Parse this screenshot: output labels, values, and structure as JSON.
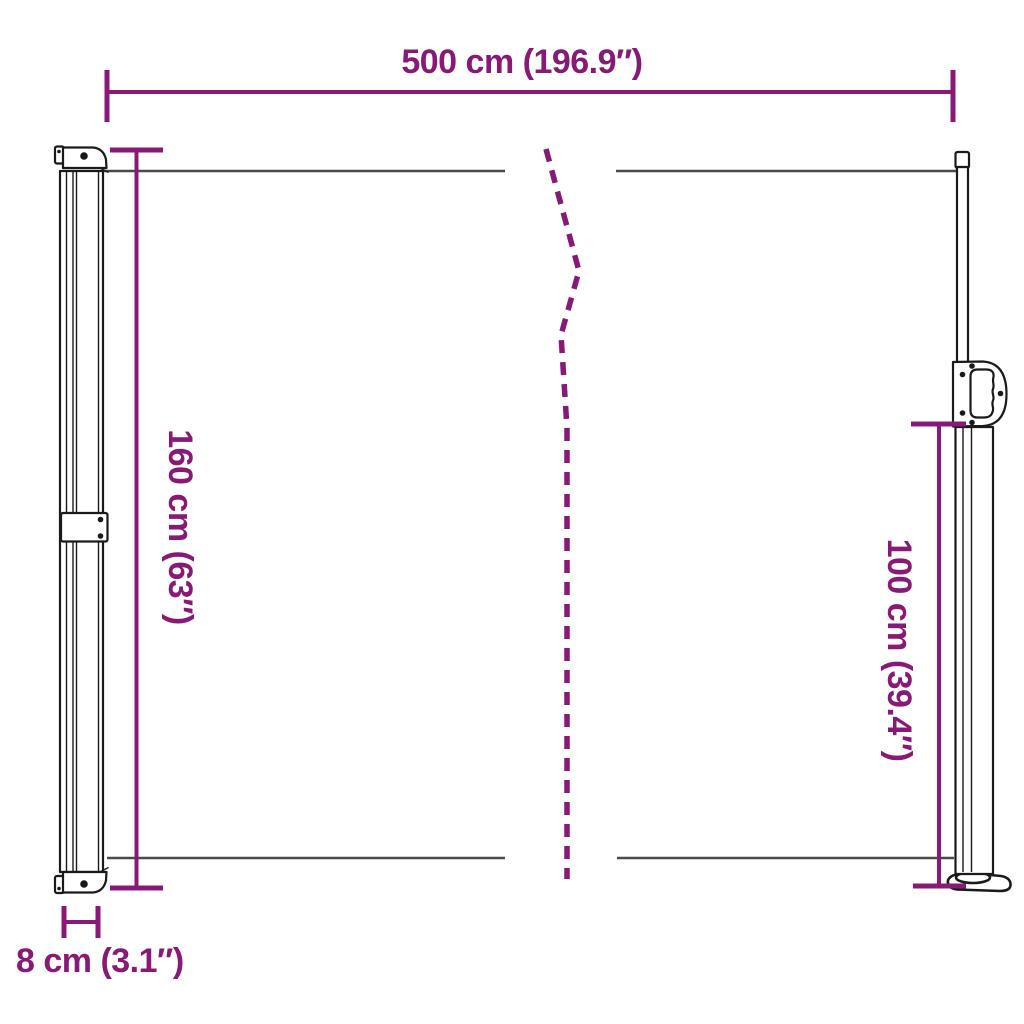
{
  "diagram": {
    "dimension_labels": {
      "width": "500 cm (196.9″)",
      "height_left": "160 cm (63″)",
      "height_right": "100 cm (39.4″)",
      "depth": "8 cm (3.1″)"
    },
    "dimension_values": {
      "width_cm": 500,
      "width_in": 196.9,
      "height_left_cm": 160,
      "height_left_in": 63,
      "height_right_cm": 100,
      "height_right_in": 39.4,
      "depth_cm": 8,
      "depth_in": 3.1
    },
    "colors": {
      "dimension": "#881977",
      "drawing_outline": "#1a1a1a",
      "fabric_line": "#4a4a4a",
      "background": "#ffffff"
    }
  }
}
